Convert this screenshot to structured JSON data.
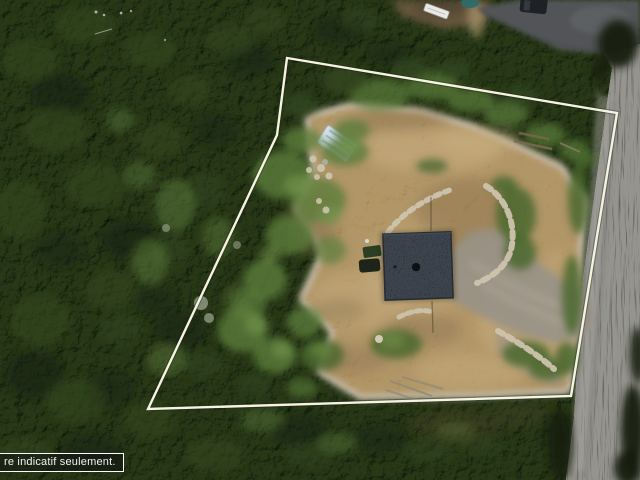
{
  "image": {
    "kind": "aerial drone photograph",
    "subject": "wooded lot with a cleared building site, square dark-roof house, dirt and gravel driveways, and a road along the right side",
    "overlay_note": "white property-boundary outline drawn over the photo"
  },
  "overlay": {
    "boundary_points": "287,58 617,113 571,396 148,409 277,135",
    "caption": {
      "text": "re indicatif seulement."
    }
  },
  "palette": {
    "forestBase": "#2a381c",
    "forestDark": "#15200f",
    "forestMid": "#33481f",
    "deciduous": "#5d7d3c",
    "deciduousLight": "#74974c",
    "grass": "#4a682e",
    "dirt": "#b1966a",
    "dirtLight": "#cbb183",
    "dirtDark": "#7e6644",
    "gravel": "#989287",
    "road": "#95948f",
    "roadStreak": "#6a6a66",
    "asphalt": "#54565a",
    "roof": "#3d444e",
    "roofEdge": "#272c33",
    "chimney": "#0e1114",
    "rock": "#cdc3ae",
    "deadTree": "#96a089",
    "pool": "#2f6b6d",
    "trailer": "#e9e9e7",
    "tarp": "#d7e4ec",
    "tarpStripe": "#8fb3cc",
    "vehicleGreen": "#2c3f24",
    "vehicleDark": "#1e2419",
    "boundary": "#f7f3e2",
    "captionText": "#f2f2f2",
    "captionBorder": "#ffffff",
    "captionBg": "rgba(18,18,18,0.55)"
  },
  "scene": {
    "features": [
      "dense coniferous forest",
      "deciduous tree clusters",
      "cleared dirt lot",
      "house with dark shingle roof",
      "chimney",
      "gravel driveway and turnaround",
      "curved rock retaining walls",
      "boulder rows",
      "white-blue tarp structure",
      "parked equipment and vehicles",
      "gravel road",
      "neighboring paved driveway",
      "parked car",
      "small pool",
      "utility trailer",
      "dead gray trees",
      "property boundary overlay",
      "caption box"
    ]
  }
}
